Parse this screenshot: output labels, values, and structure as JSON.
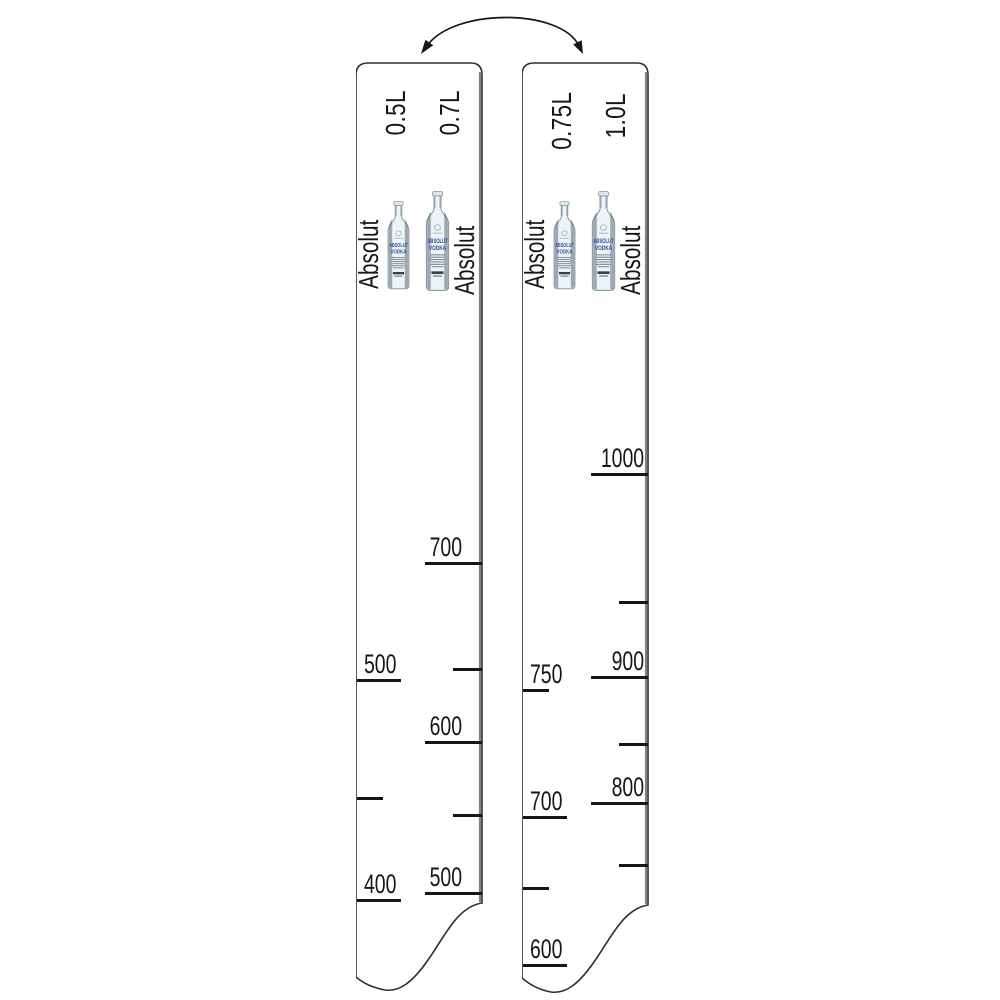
{
  "illustration": {
    "kind": "bar-ruler-product-diagram",
    "flip_arrow": "curved-double-headed-arrow"
  },
  "colors": {
    "ink": "#161616",
    "edge_shadow": "#828282",
    "brand_blue": "#2b4d9e"
  },
  "bottle": {
    "line1": "ABSOLUT",
    "line2": "VODKA"
  },
  "strips": [
    {
      "name": "ruler-side-0.5L-0.7L",
      "left_volume": "0.5L",
      "right_volume": "0.7L",
      "brand_left": "Absolut",
      "brand_right": "Absolut",
      "left_scale_marks": [
        {
          "label": "500",
          "y": 680,
          "tick": "long"
        },
        {
          "label": "",
          "y": 798,
          "tick": "short"
        },
        {
          "label": "400",
          "y": 900,
          "tick": "long"
        }
      ],
      "right_scale_marks": [
        {
          "label": "700",
          "y": 563,
          "tick": "long"
        },
        {
          "label": "",
          "y": 669,
          "tick": "short"
        },
        {
          "label": "600",
          "y": 742,
          "tick": "long"
        },
        {
          "label": "",
          "y": 815,
          "tick": "short"
        },
        {
          "label": "500",
          "y": 893,
          "tick": "long"
        }
      ]
    },
    {
      "name": "ruler-side-0.75L-1.0L",
      "left_volume": "0.75L",
      "right_volume": "1.0L",
      "brand_left": "Absolut",
      "brand_right": "Absolut",
      "left_scale_marks": [
        {
          "label": "750",
          "y": 690,
          "tick": "short"
        },
        {
          "label": "700",
          "y": 817,
          "tick": "long"
        },
        {
          "label": "",
          "y": 888,
          "tick": "short"
        },
        {
          "label": "600",
          "y": 965,
          "tick": "long"
        }
      ],
      "right_scale_marks": [
        {
          "label": "1000",
          "y": 474,
          "tick": "long"
        },
        {
          "label": "",
          "y": 602,
          "tick": "short"
        },
        {
          "label": "900",
          "y": 677,
          "tick": "long"
        },
        {
          "label": "",
          "y": 744,
          "tick": "short"
        },
        {
          "label": "800",
          "y": 803,
          "tick": "long"
        },
        {
          "label": "",
          "y": 865,
          "tick": "short"
        }
      ]
    }
  ]
}
